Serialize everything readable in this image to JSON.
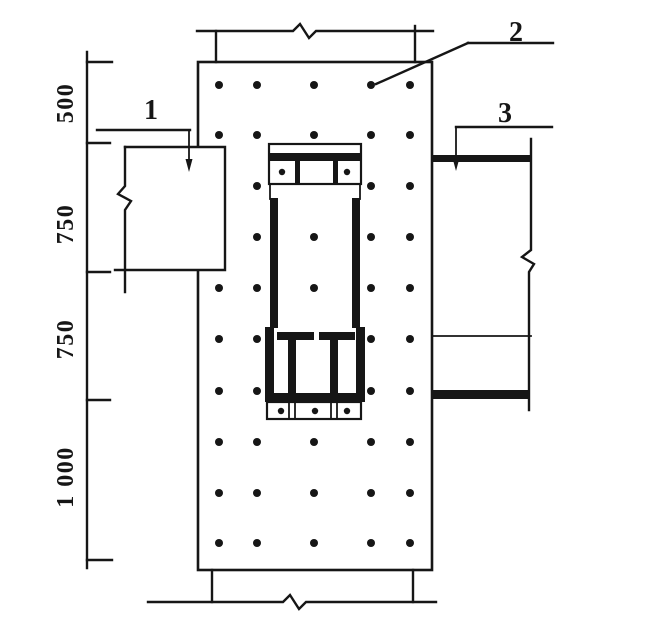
{
  "figure": {
    "kind": "structural-joint-detail-drawing",
    "background_color": "#ffffff",
    "line_color": "#161616"
  },
  "dimensions": {
    "labels": [
      "500",
      "750",
      "750",
      "1 000"
    ]
  },
  "callouts": {
    "c1": "1",
    "c2": "2",
    "c3": "3"
  },
  "anchor_dots": {
    "radius": 4,
    "points": [
      [
        219,
        85
      ],
      [
        257,
        85
      ],
      [
        314,
        85
      ],
      [
        371,
        85
      ],
      [
        410,
        85
      ],
      [
        219,
        135
      ],
      [
        257,
        135
      ],
      [
        314,
        135
      ],
      [
        371,
        135
      ],
      [
        410,
        135
      ],
      [
        257,
        186
      ],
      [
        371,
        186
      ],
      [
        410,
        186
      ],
      [
        257,
        237
      ],
      [
        314,
        237
      ],
      [
        371,
        237
      ],
      [
        410,
        237
      ],
      [
        219,
        288
      ],
      [
        257,
        288
      ],
      [
        314,
        288
      ],
      [
        371,
        288
      ],
      [
        410,
        288
      ],
      [
        219,
        339
      ],
      [
        257,
        339
      ],
      [
        371,
        339
      ],
      [
        410,
        339
      ],
      [
        219,
        391
      ],
      [
        257,
        391
      ],
      [
        371,
        391
      ],
      [
        410,
        391
      ],
      [
        219,
        442
      ],
      [
        257,
        442
      ],
      [
        314,
        442
      ],
      [
        371,
        442
      ],
      [
        410,
        442
      ],
      [
        219,
        493
      ],
      [
        257,
        493
      ],
      [
        314,
        493
      ],
      [
        371,
        493
      ],
      [
        410,
        493
      ],
      [
        219,
        543
      ],
      [
        257,
        543
      ],
      [
        314,
        543
      ],
      [
        371,
        543
      ],
      [
        410,
        543
      ]
    ]
  },
  "bolt_dots": {
    "radius": 3.2,
    "points": [
      [
        282,
        172
      ],
      [
        347,
        172
      ],
      [
        281,
        411
      ],
      [
        315,
        411
      ],
      [
        347,
        411
      ]
    ]
  }
}
